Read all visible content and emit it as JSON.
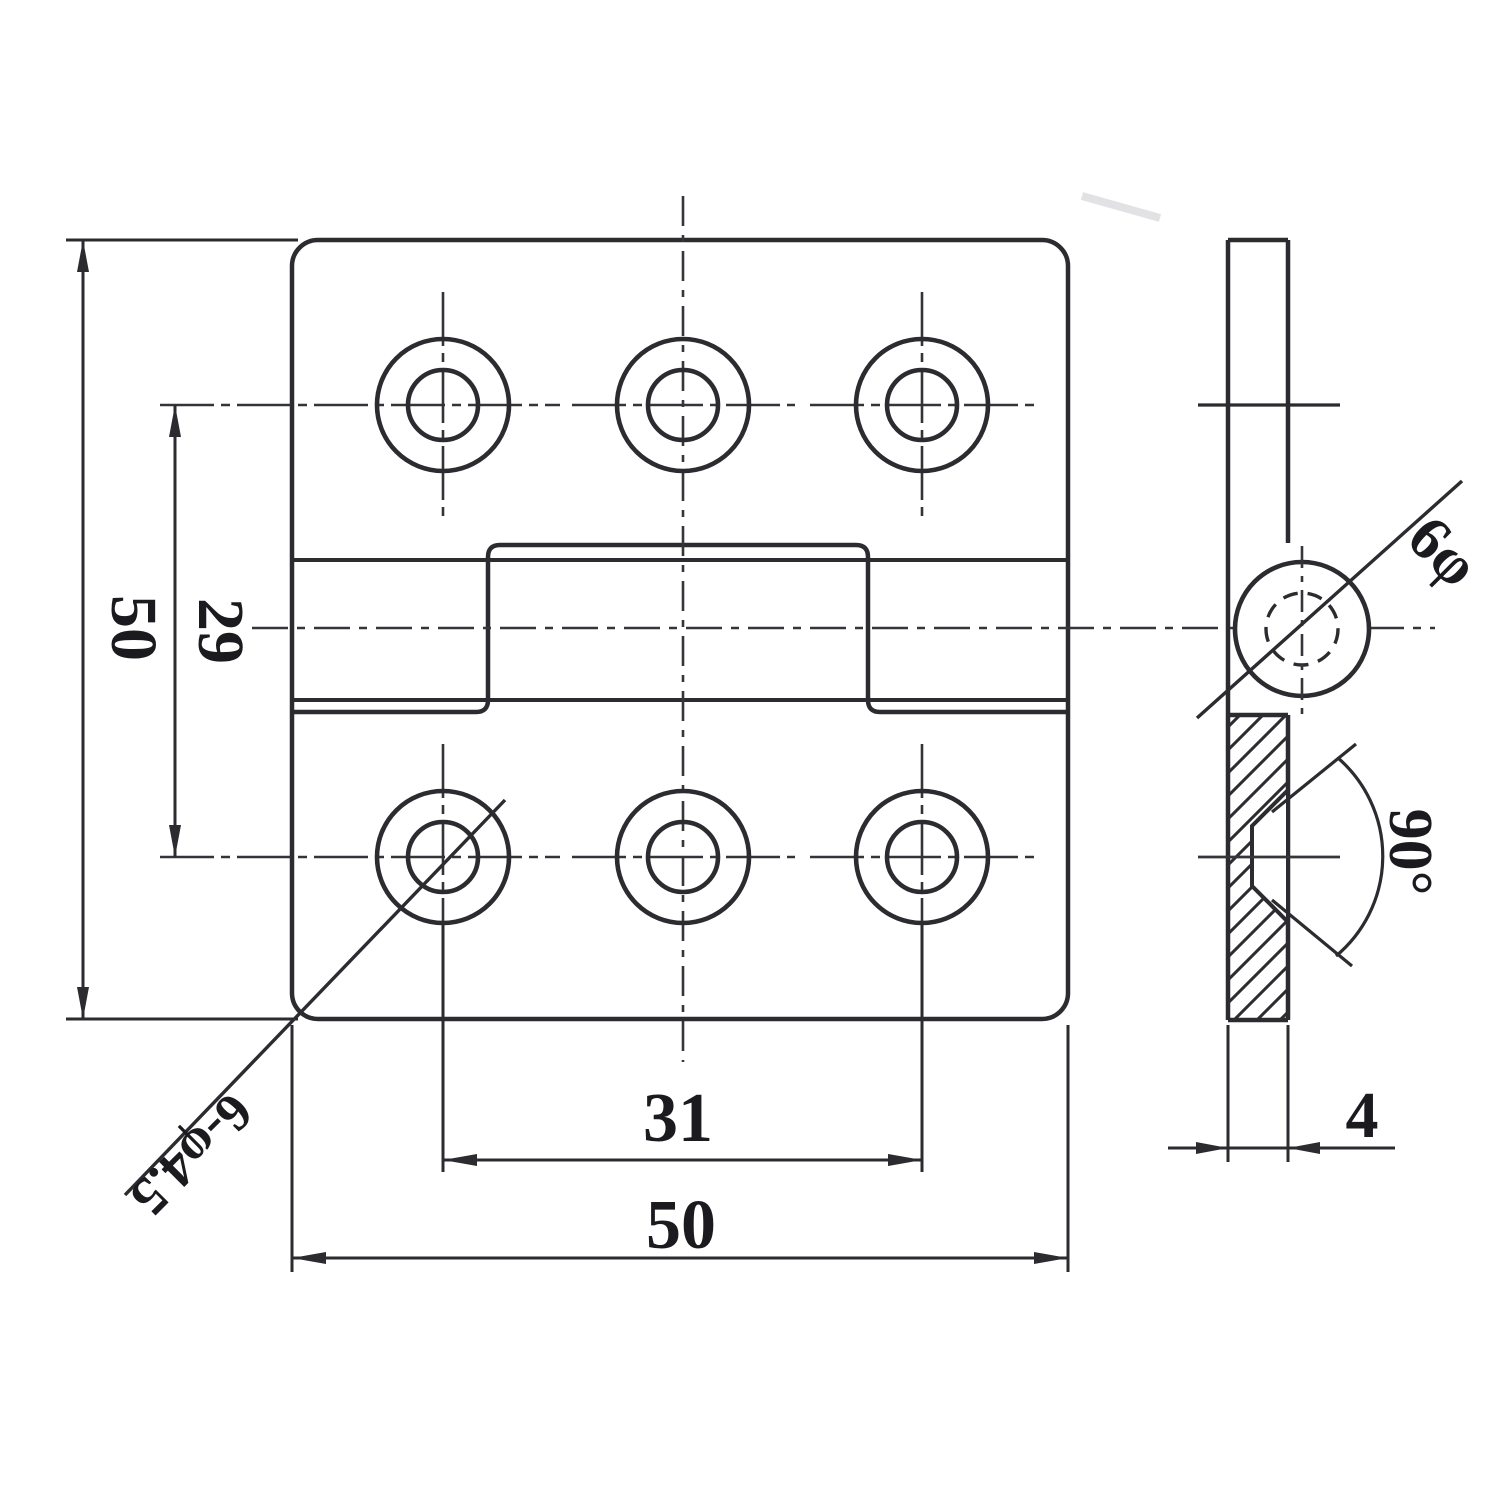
{
  "drawing": {
    "dims": {
      "plate_height": "50",
      "hole_row_spacing": "29",
      "hole_col_spacing": "31",
      "plate_width": "50",
      "thickness": "4",
      "countersink_angle": "90°",
      "pin_diameter": "6φ",
      "screw_holes": "6-φ4.5"
    }
  }
}
